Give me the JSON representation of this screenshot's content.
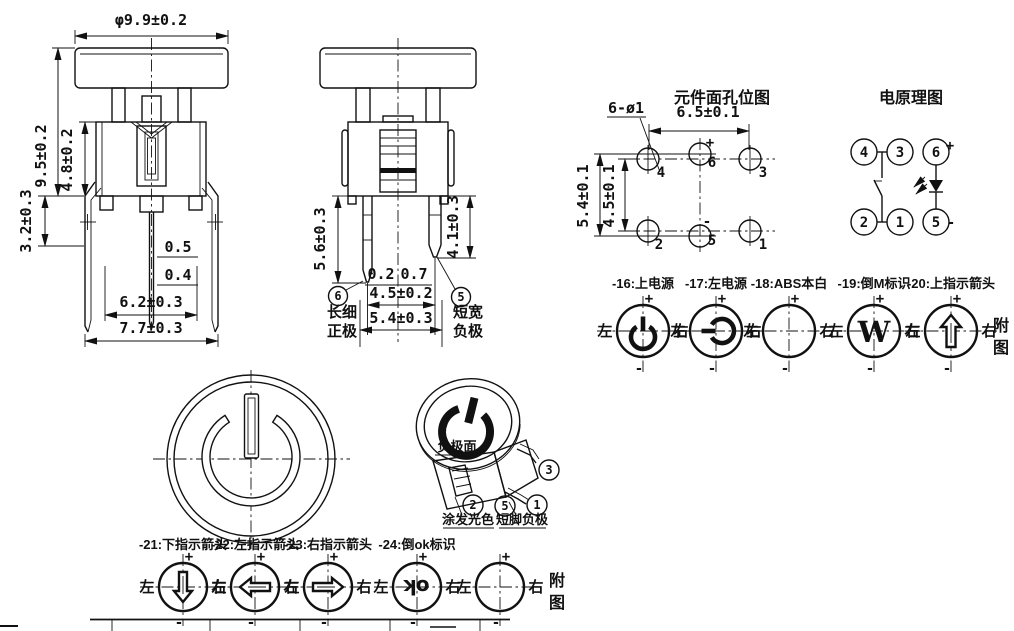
{
  "drawing": {
    "front_view": {
      "dia": "φ9.9±0.2",
      "h_total": "9.5±0.2",
      "h_body": "4.8±0.2",
      "h_leg": "3.2±0.3",
      "pin_w_top": "0.5",
      "pin_w_bot": "0.4",
      "w_inner": "6.2±0.3",
      "w_outer": "7.7±0.3"
    },
    "side_view": {
      "pin_long": "5.6±0.3",
      "pin_short": "4.1±0.3",
      "off_left": "0.2",
      "off_right": "0.7",
      "pin_pitch": "4.5±0.2",
      "body_w": "5.4±0.3",
      "callout_pos": {
        "num": "6",
        "l1": "长细",
        "l2": "正极"
      },
      "callout_neg": {
        "num": "5",
        "l1": "短宽",
        "l2": "负极"
      }
    },
    "hole_map": {
      "title": "元件面孔位图",
      "note": "6-ø1",
      "dim_w": "6.5±0.1",
      "dim_v_outer": "5.4±0.1",
      "dim_v_inner": "4.5±0.1",
      "pins": [
        "4",
        "6",
        "3",
        "2",
        "5",
        "1"
      ]
    },
    "schematic": {
      "title": "电原理图",
      "pins": [
        "4",
        "3",
        "6",
        "2",
        "1",
        "5"
      ]
    },
    "iso": {
      "face": "负极面",
      "paint": "涂发光色",
      "short_pin": "短脚负极",
      "balloons": [
        "3",
        "2",
        "5",
        "1"
      ]
    }
  },
  "options": {
    "row1": [
      {
        "label": "-16:上电源",
        "icon": "power-up"
      },
      {
        "label": "-17:左电源",
        "icon": "power-left"
      },
      {
        "label": "-18:ABS本白",
        "icon": "blank"
      },
      {
        "label": "-19:倒M标识",
        "icon": "inverted-m"
      },
      {
        "label": "-20:上指示箭头",
        "icon": "arrow-up"
      }
    ],
    "row2": [
      {
        "label": "-21:下指示箭头",
        "icon": "arrow-down"
      },
      {
        "label": "-22:左指示箭头",
        "icon": "arrow-left"
      },
      {
        "label": "-23:右指示箭头",
        "icon": "arrow-right"
      },
      {
        "label": "-24:倒ok标识",
        "icon": "inverted-ok"
      },
      {
        "label": "",
        "icon": "blank"
      }
    ],
    "m_glyph": "W",
    "ok_glyph": "ok",
    "note1": "附",
    "note2": "图"
  },
  "shared": {
    "left": "左",
    "right": "右",
    "plus": "+",
    "minus": "-"
  },
  "colors": {
    "line": "#111111",
    "background": "#ffffff"
  }
}
